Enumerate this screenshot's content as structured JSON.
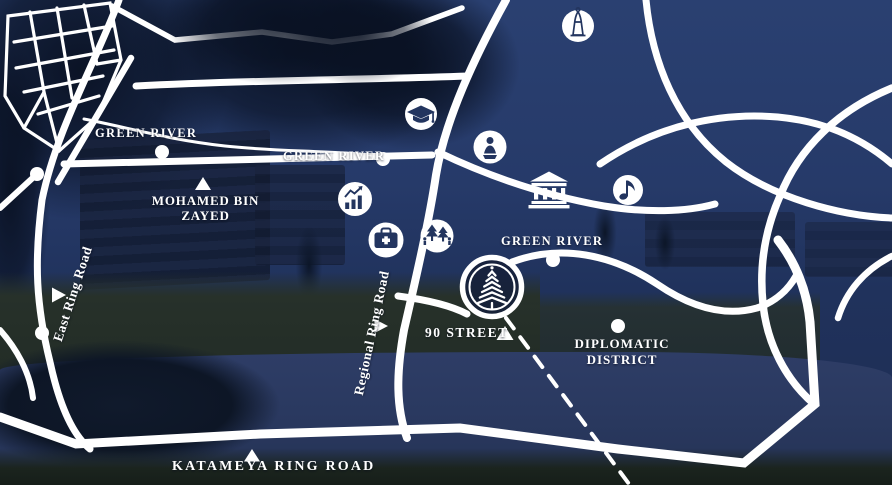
{
  "map": {
    "road_labels": {
      "green_river_upper": "GREEN RIVER",
      "green_river_middle": "GREEN RIVER",
      "green_river_lower": "GREEN RIVER",
      "mohamed_bin_zayed_line1": "MOHAMED BIN",
      "mohamed_bin_zayed_line2": "ZAYED",
      "east_ring_road": "East Ring Road",
      "regional_ring_road": "Regional Ring Road",
      "street_90": "90 STREET",
      "diplomatic_district_line1": "DIPLOMATIC",
      "diplomatic_district_line2": "DISTRICT",
      "katameya_ring_road": "KATAMEYA RING ROAD"
    },
    "poi_icons": [
      "monument-icon",
      "graduation-cap-icon",
      "statue-icon",
      "museum-icon",
      "music-note-icon",
      "growth-chart-icon",
      "medical-kit-icon",
      "park-trees-icon",
      "project-tree-logo"
    ],
    "colors": {
      "road": "#ffffff",
      "icon_glyph": "#23355f",
      "sky": "#26396a",
      "water": "#2a3a63",
      "label_text": "#ffffff"
    }
  }
}
